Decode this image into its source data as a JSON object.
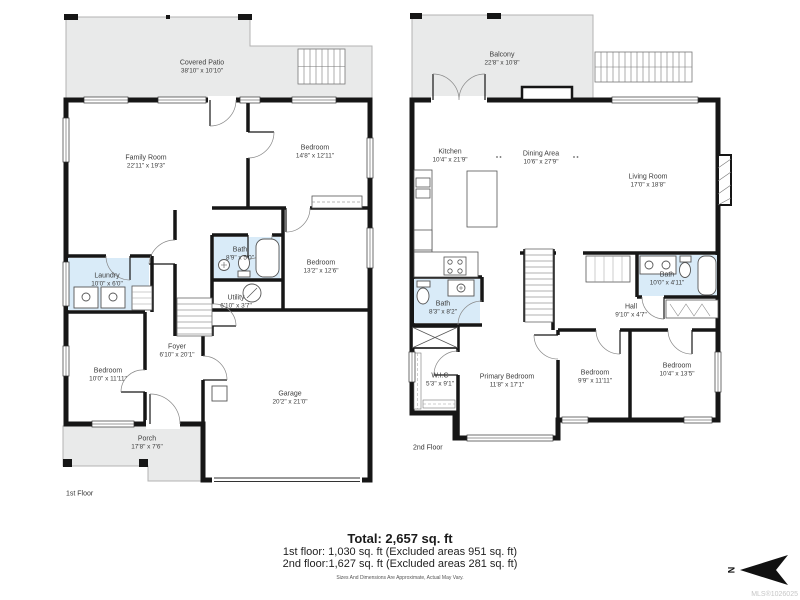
{
  "floors": [
    {
      "label": "1st Floor",
      "rooms": [
        {
          "name": "Covered Patio",
          "dims": "38'10\" x 10'10\""
        },
        {
          "name": "Family Room",
          "dims": "22'11\" x 19'3\""
        },
        {
          "name": "Bedroom",
          "dims": "14'8\" x 12'11\""
        },
        {
          "name": "Bath",
          "dims": "8'9\" x 5'0\""
        },
        {
          "name": "Bedroom",
          "dims": "13'2\" x 12'6\""
        },
        {
          "name": "Laundry",
          "dims": "10'0\" x 6'0\""
        },
        {
          "name": "Utility",
          "dims": "6'10\" x 3'7\""
        },
        {
          "name": "Foyer",
          "dims": "6'10\" x 20'1\""
        },
        {
          "name": "Bedroom",
          "dims": "10'0\" x 11'11\""
        },
        {
          "name": "Garage",
          "dims": "20'2\" x 21'0\""
        },
        {
          "name": "Porch",
          "dims": "17'8\" x 7'6\""
        }
      ]
    },
    {
      "label": "2nd Floor",
      "rooms": [
        {
          "name": "Balcony",
          "dims": "22'8\" x 10'8\""
        },
        {
          "name": "Kitchen",
          "dims": "10'4\" x 21'9\""
        },
        {
          "name": "Dining Area",
          "dims": "10'6\" x 27'9\""
        },
        {
          "name": "Living Room",
          "dims": "17'0\" x 18'8\""
        },
        {
          "name": "Bath",
          "dims": "8'3\" x 8'2\""
        },
        {
          "name": "Hall",
          "dims": "9'10\" x 4'7\""
        },
        {
          "name": "Bath",
          "dims": "10'0\" x 4'11\""
        },
        {
          "name": "W.I.C",
          "dims": "5'3\" x 9'1\""
        },
        {
          "name": "Primary Bedroom",
          "dims": "11'8\" x 17'1\""
        },
        {
          "name": "Bedroom",
          "dims": "9'9\" x 11'11\""
        },
        {
          "name": "Bedroom",
          "dims": "10'4\" x 13'5\""
        }
      ]
    }
  ],
  "summary": {
    "total": "Total: 2,657 sq. ft",
    "first": "1st floor: 1,030 sq. ft (Excluded areas 951 sq. ft)",
    "second": "2nd floor:1,627 sq. ft (Excluded areas 281 sq. ft)",
    "disclaimer": "Sizes And Dimensions Are Approximate, Actual May Vary."
  },
  "compass": {
    "letter": "N"
  },
  "watermark": "MLS®1026025",
  "colors": {
    "wall": "#161616",
    "outdoor_fill": "#e9eaea",
    "bath_fill": "#d9ebf8",
    "watermark": "#c6c6c6"
  }
}
